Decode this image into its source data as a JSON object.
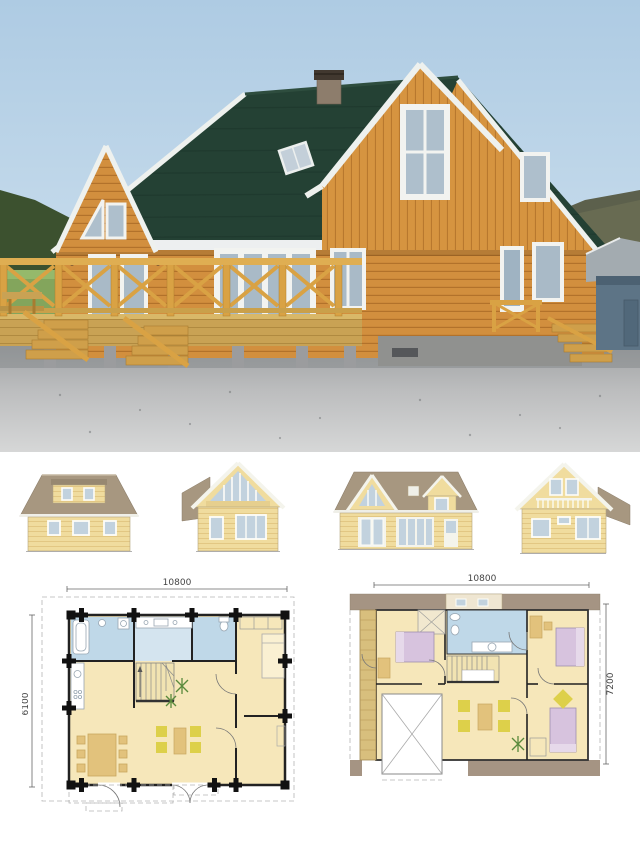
{
  "floor_plans": {
    "ground_floor": {
      "width_label": "10800",
      "depth_label": "6100"
    },
    "upper_floor": {
      "width_label": "10800",
      "depth_label": "7200"
    }
  },
  "colors": {
    "sky_top": "#aecbe3",
    "sky_bottom": "#dde9f2",
    "photo_roof": "#244134",
    "photo_wall": "#d28f3e",
    "deck_wood": "#c9a254",
    "trim_white": "#eef1ee",
    "shed_wall": "#5d7486",
    "gravel_light": "#d6d7d7",
    "elevation_roof": "#a79780",
    "elevation_wall": "#f0dc9e",
    "glass_blue": "#c2d2de",
    "plan_floor": "#f6e7ba",
    "plan_wet": "#bfd8e8",
    "plan_roof": "#a59483",
    "plan_balcony": "#d8bf7d",
    "plan_bed": "#d7c3de",
    "plan_chair_yellow": "#ddd04a",
    "plan_table_tan": "#e2c27c",
    "dim_text": "#444444"
  }
}
